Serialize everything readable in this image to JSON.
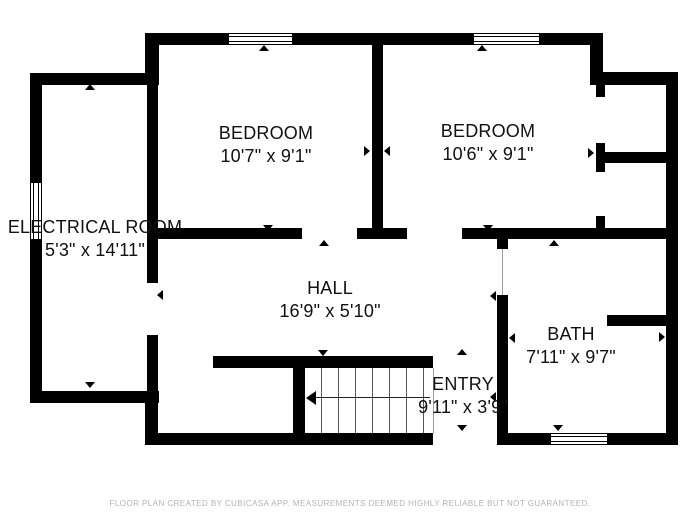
{
  "page": {
    "background": "#ffffff"
  },
  "colors": {
    "wall": "#000000",
    "room_text": "#111111",
    "footer_text": "#b3b3b3"
  },
  "rooms": {
    "bedroom_left": {
      "name": "BEDROOM",
      "dimensions": "10'7\" x 9'1\""
    },
    "bedroom_right": {
      "name": "BEDROOM",
      "dimensions": "10'6\" x 9'1\""
    },
    "electrical": {
      "name": "ELECTRICAL ROOM",
      "dimensions": "5'3\" x 14'11\""
    },
    "hall": {
      "name": "HALL",
      "dimensions": "16'9\" x 5'10\""
    },
    "bath": {
      "name": "BATH",
      "dimensions": "7'11\" x 9'7\""
    },
    "entry": {
      "name": "ENTRY",
      "dimensions": "9'11\" x 3'9\""
    }
  },
  "footer": {
    "disclaimer": "FLOOR PLAN CREATED BY CUBICASA APP. MEASUREMENTS DEEMED HIGHLY RELIABLE BUT NOT GUARANTEED."
  }
}
